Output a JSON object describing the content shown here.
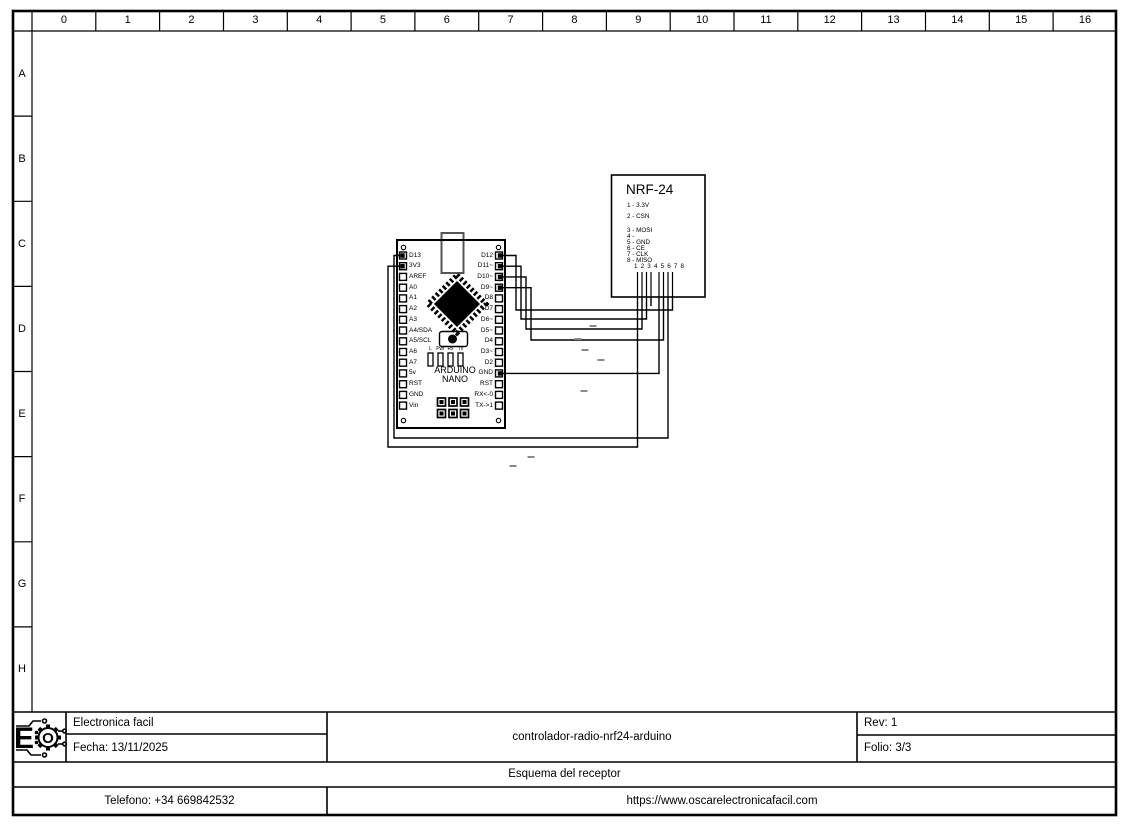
{
  "frame": {
    "columns": [
      "0",
      "1",
      "2",
      "3",
      "4",
      "5",
      "6",
      "7",
      "8",
      "9",
      "10",
      "11",
      "12",
      "13",
      "14",
      "15",
      "16"
    ],
    "rows": [
      "A",
      "B",
      "C",
      "D",
      "E",
      "F",
      "G",
      "H"
    ]
  },
  "arduino": {
    "name_line1": "ARDUINO",
    "name_line2": "NANO",
    "left_pins": [
      "D13",
      "3V3",
      "AREF",
      "A0",
      "A1",
      "A2",
      "A3",
      "A4/SDA",
      "A5/SCL",
      "A6",
      "A7",
      "5v",
      "RST",
      "GND",
      "Vin"
    ],
    "right_pins": [
      "D12",
      "D11~",
      "D10~",
      "D9~",
      "D8",
      "D7",
      "D6~",
      "D5~",
      "D4",
      "D3~",
      "D2",
      "GND",
      "RST",
      "RX<-0",
      "TX->1"
    ],
    "led_labels": [
      "L",
      "Pwr",
      "Rx",
      "Tx"
    ]
  },
  "nrf24": {
    "title": "NRF-24",
    "pins": [
      "1 - 3.3V",
      "2 - CSN",
      "3 - MOSI",
      "4 -",
      "5 - GND",
      "6 - CE",
      "7 - CLK",
      "8 - MISO"
    ],
    "pin_numbers_row": "1 2 3 4 5 6 7 8"
  },
  "connections": [
    {
      "arduino": "D12",
      "nrf24": "8 - MISO"
    },
    {
      "arduino": "D11~",
      "nrf24": "3 - MOSI"
    },
    {
      "arduino": "D10~",
      "nrf24": "2 - CSN"
    },
    {
      "arduino": "D9~",
      "nrf24": "6 - CE"
    },
    {
      "arduino": "GND",
      "nrf24": "5 - GND"
    },
    {
      "arduino": "D13",
      "nrf24": "7 - CLK"
    },
    {
      "arduino": "3V3",
      "nrf24": "1 - 3.3V"
    }
  ],
  "title_block": {
    "company": "Electronica facil",
    "date": "Fecha: 13/11/2025",
    "project": "controlador-radio-nrf24-arduino",
    "rev": "Rev: 1",
    "folio": "Folio: 3/3",
    "sheet_title": "Esquema del receptor",
    "phone": "Telefono: +34 669842532",
    "website": "https://www.oscarelectronicafacil.com",
    "logo_letter_e": "E",
    "logo_letter_o": "O"
  }
}
